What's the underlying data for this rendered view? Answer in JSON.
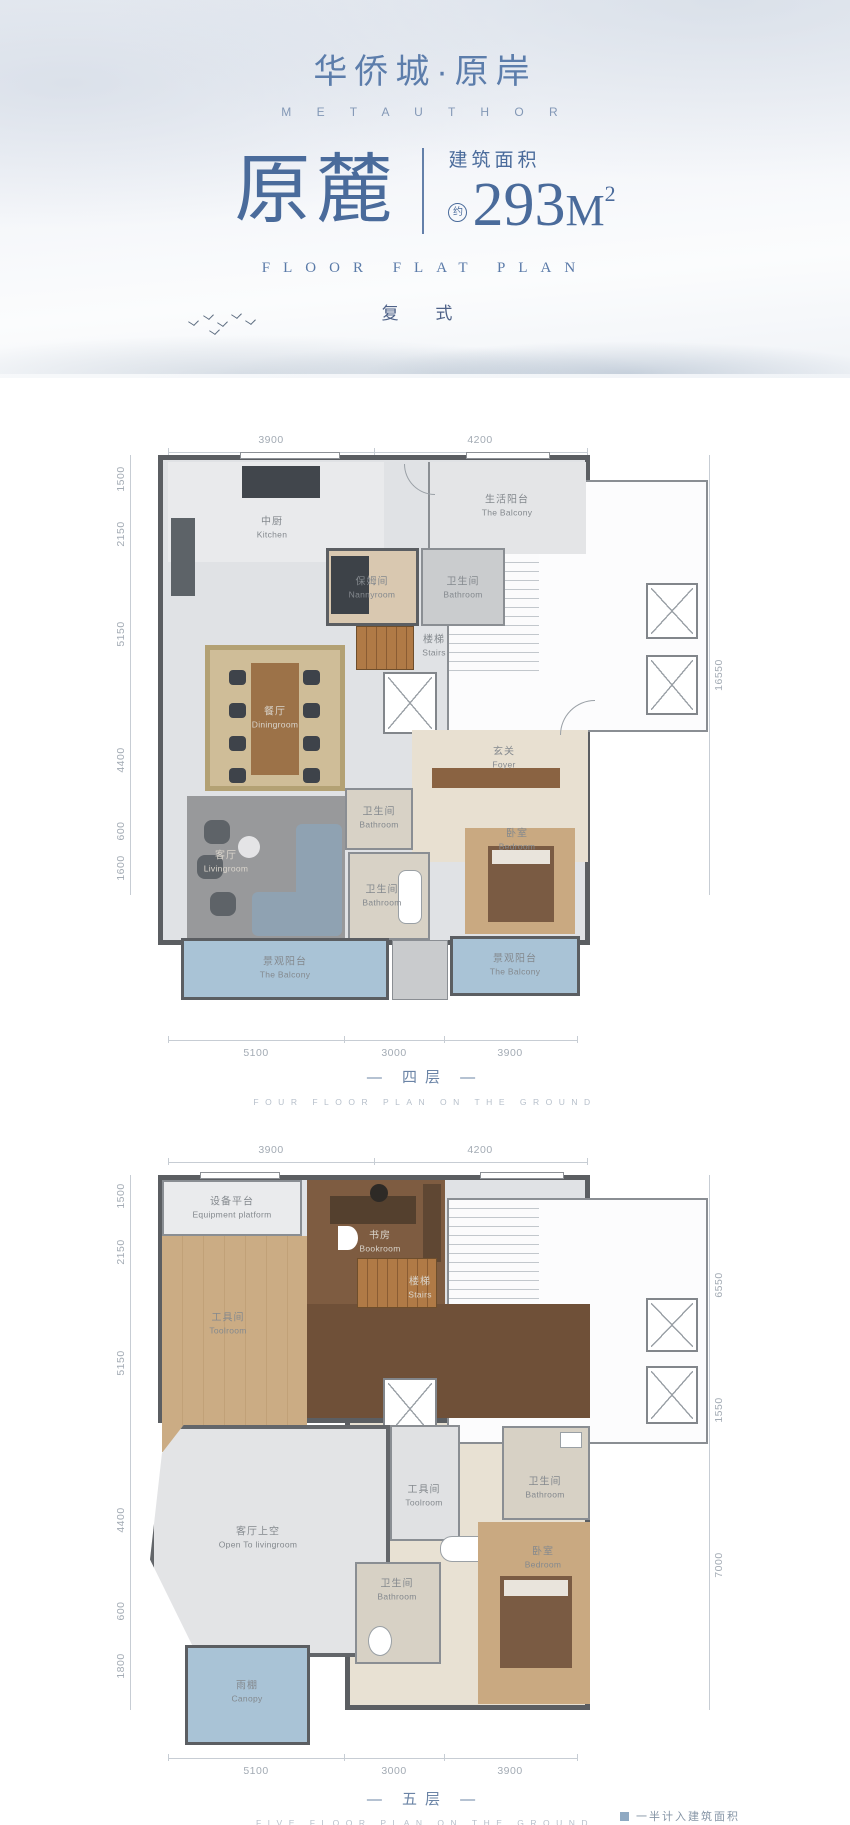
{
  "header": {
    "logo_cn": "华侨城·原岸",
    "logo_en": "M E T A U T H O R",
    "title": "原麓",
    "area_label": "建筑面积",
    "area_prefix": "约",
    "area_value": "293",
    "area_unit": "M",
    "area_exp": "2",
    "tagline": "FLOOR FLAT PLAN",
    "type_label": "复 式"
  },
  "colors": {
    "brand_blue": "#4a6b9b",
    "wall_gray": "#5b5e62",
    "balcony_blue": "#a9c3d6",
    "wood_light": "#cbac84",
    "wood_dark": "#6f5038",
    "dim_gray": "#a3abb4"
  },
  "floor4": {
    "caption_cn": "— 四层 —",
    "caption_en": "FOUR FLOOR PLAN ON THE GROUND",
    "dims_top": [
      "3900",
      "4200"
    ],
    "dims_left": [
      "1500",
      "2150",
      "5150",
      "4400",
      "600",
      "1600"
    ],
    "dims_right": [
      "16550"
    ],
    "dims_bottom": [
      "5100",
      "3000",
      "3900"
    ],
    "rooms": [
      {
        "cn": "中厨",
        "en": "Kitchen"
      },
      {
        "cn": "生活阳台",
        "en": "The Balcony"
      },
      {
        "cn": "保姆间",
        "en": "Nannyroom"
      },
      {
        "cn": "卫生间",
        "en": "Bathroom"
      },
      {
        "cn": "楼梯",
        "en": "Stairs"
      },
      {
        "cn": "餐厅",
        "en": "Diningroom"
      },
      {
        "cn": "玄关",
        "en": "Foyer"
      },
      {
        "cn": "卫生间",
        "en": "Bathroom"
      },
      {
        "cn": "客厅",
        "en": "Livingroom"
      },
      {
        "cn": "卫生间",
        "en": "Bathroom"
      },
      {
        "cn": "卧室",
        "en": "Bedroom"
      },
      {
        "cn": "景观阳台",
        "en": "The Balcony"
      },
      {
        "cn": "景观阳台",
        "en": "The Balcony"
      }
    ]
  },
  "floor5": {
    "caption_cn": "— 五层 —",
    "caption_en": "FIVE FLOOR PLAN ON THE GROUND",
    "dims_top": [
      "3900",
      "4200"
    ],
    "dims_left": [
      "1500",
      "2150",
      "5150",
      "4400",
      "600",
      "1800"
    ],
    "dims_right": [
      "6550",
      "1550",
      "7000"
    ],
    "dims_bottom": [
      "5100",
      "3000",
      "3900"
    ],
    "rooms": [
      {
        "cn": "设备平台",
        "en": "Equipment platform"
      },
      {
        "cn": "书房",
        "en": "Bookroom"
      },
      {
        "cn": "工具间",
        "en": "Toolroom"
      },
      {
        "cn": "楼梯",
        "en": "Stairs"
      },
      {
        "cn": "客厅上空",
        "en": "Open To livingroom"
      },
      {
        "cn": "工具间",
        "en": "Toolroom"
      },
      {
        "cn": "卫生间",
        "en": "Bathroom"
      },
      {
        "cn": "卫生间",
        "en": "Bathroom"
      },
      {
        "cn": "卧室",
        "en": "Bedroom"
      },
      {
        "cn": "雨棚",
        "en": "Canopy"
      }
    ]
  },
  "footnote": {
    "legend": "一半计入建筑面积"
  }
}
